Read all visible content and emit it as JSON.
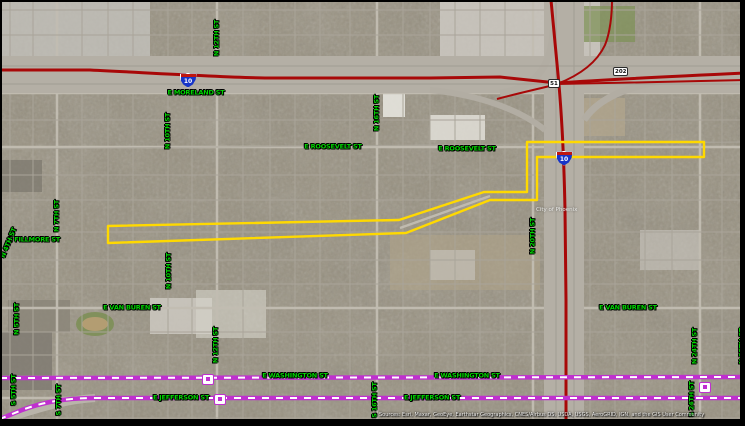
{
  "map": {
    "view": "satellite-imagery-with-street-overlay",
    "city_overlay_label": {
      "text": "City of Phoenix",
      "x": 556,
      "y": 210
    },
    "attribution": "Sources: Esri, Maxar, GeoEye, Earthstar Geographics, CNES/Airbus DS, USDA, USGS, AeroGRID, IGN, and the GIS User Community",
    "colors": {
      "street_label": "#00d400",
      "route_highlight": "#ffd900",
      "light_rail": "#bf30cf",
      "freeway_red": "#a80808"
    },
    "street_labels": [
      {
        "text": "E MORELAND ST",
        "x": 196,
        "y": 93,
        "rot": 0
      },
      {
        "text": "E ROOSEVELT ST",
        "x": 333,
        "y": 147,
        "rot": 0
      },
      {
        "text": "E ROOSEVELT ST",
        "x": 467,
        "y": 149,
        "rot": 0
      },
      {
        "text": "E FILLMORE ST",
        "x": 34,
        "y": 240,
        "rot": 0
      },
      {
        "text": "E VAN BUREN ST",
        "x": 132,
        "y": 308,
        "rot": 0
      },
      {
        "text": "E VAN BUREN ST",
        "x": 628,
        "y": 308,
        "rot": 0
      },
      {
        "text": "E WASHINGTON ST",
        "x": 295,
        "y": 376,
        "rot": 0
      },
      {
        "text": "E WASHINGTON ST",
        "x": 467,
        "y": 376,
        "rot": 0
      },
      {
        "text": "E JEFFERSON ST",
        "x": 181,
        "y": 398,
        "rot": 0
      },
      {
        "text": "E JEFFERSON ST",
        "x": 432,
        "y": 398,
        "rot": 0
      },
      {
        "text": "N 4TH ST",
        "x": 9,
        "y": 243,
        "rot": -68
      },
      {
        "text": "N 5TH ST",
        "x": 17,
        "y": 319,
        "rot": -90
      },
      {
        "text": "S 5TH ST",
        "x": 14,
        "y": 390,
        "rot": -90
      },
      {
        "text": "N 7TH ST",
        "x": 57,
        "y": 216,
        "rot": -90
      },
      {
        "text": "S 7TH ST",
        "x": 59,
        "y": 400,
        "rot": -90
      },
      {
        "text": "N 10TH ST",
        "x": 168,
        "y": 131,
        "rot": -90
      },
      {
        "text": "N 10TH ST",
        "x": 169,
        "y": 271,
        "rot": -90
      },
      {
        "text": "N 12TH ST",
        "x": 217,
        "y": 38,
        "rot": -90
      },
      {
        "text": "N 12TH ST",
        "x": 216,
        "y": 345,
        "rot": -90
      },
      {
        "text": "N 16TH ST",
        "x": 377,
        "y": 113,
        "rot": -90
      },
      {
        "text": "S 16TH ST",
        "x": 375,
        "y": 400,
        "rot": -90
      },
      {
        "text": "N 20TH ST",
        "x": 533,
        "y": 236,
        "rot": -90
      },
      {
        "text": "N 24TH ST",
        "x": 695,
        "y": 346,
        "rot": -90
      },
      {
        "text": "S 24TH ST",
        "x": 692,
        "y": 399,
        "rot": -90
      },
      {
        "text": "N 25TH ST",
        "x": 742,
        "y": 346,
        "rot": -90
      }
    ],
    "interstate_shields": [
      {
        "number": "10",
        "x": 187,
        "y": 79
      },
      {
        "number": "10",
        "x": 563,
        "y": 157
      }
    ],
    "route_shields": [
      {
        "number": "51",
        "x": 556,
        "y": 84
      },
      {
        "number": "202",
        "x": 621,
        "y": 72
      }
    ],
    "rail_markers": [
      {
        "x": 207,
        "y": 378
      },
      {
        "x": 219,
        "y": 398
      },
      {
        "x": 704,
        "y": 386
      }
    ],
    "route_overlay": {
      "description": "yellow highlighted project corridor",
      "path": "M108,226 L399,220 L484,192 L527,192 L527,142 L704,142 L704,157 L537,157 L537,200 L490,200 L406,233 L108,243 Z"
    },
    "rail_lines": {
      "washington_path": "M0,378 L745,377",
      "jefferson_path": "M745,398 L95,398 C60,398 38,404 22,410 C12,414 5,417 0,419"
    },
    "freeway_lines": {
      "i10_main": "M0,70 L90,70 C170,74 220,77 265,78 L430,78 L500,77 L557,83 C600,80 680,76 745,73",
      "east_branch": "M557,84 C620,83 690,81 745,80",
      "vertical": "M551,0 C555,40 557,65 559,85 C562,120 564,160 565,210 L566,300 L566,420",
      "ramp": "M497,99 C523,92 543,88 557,84 C583,74 598,60 605,45 C610,33 612,15 612,0"
    }
  }
}
